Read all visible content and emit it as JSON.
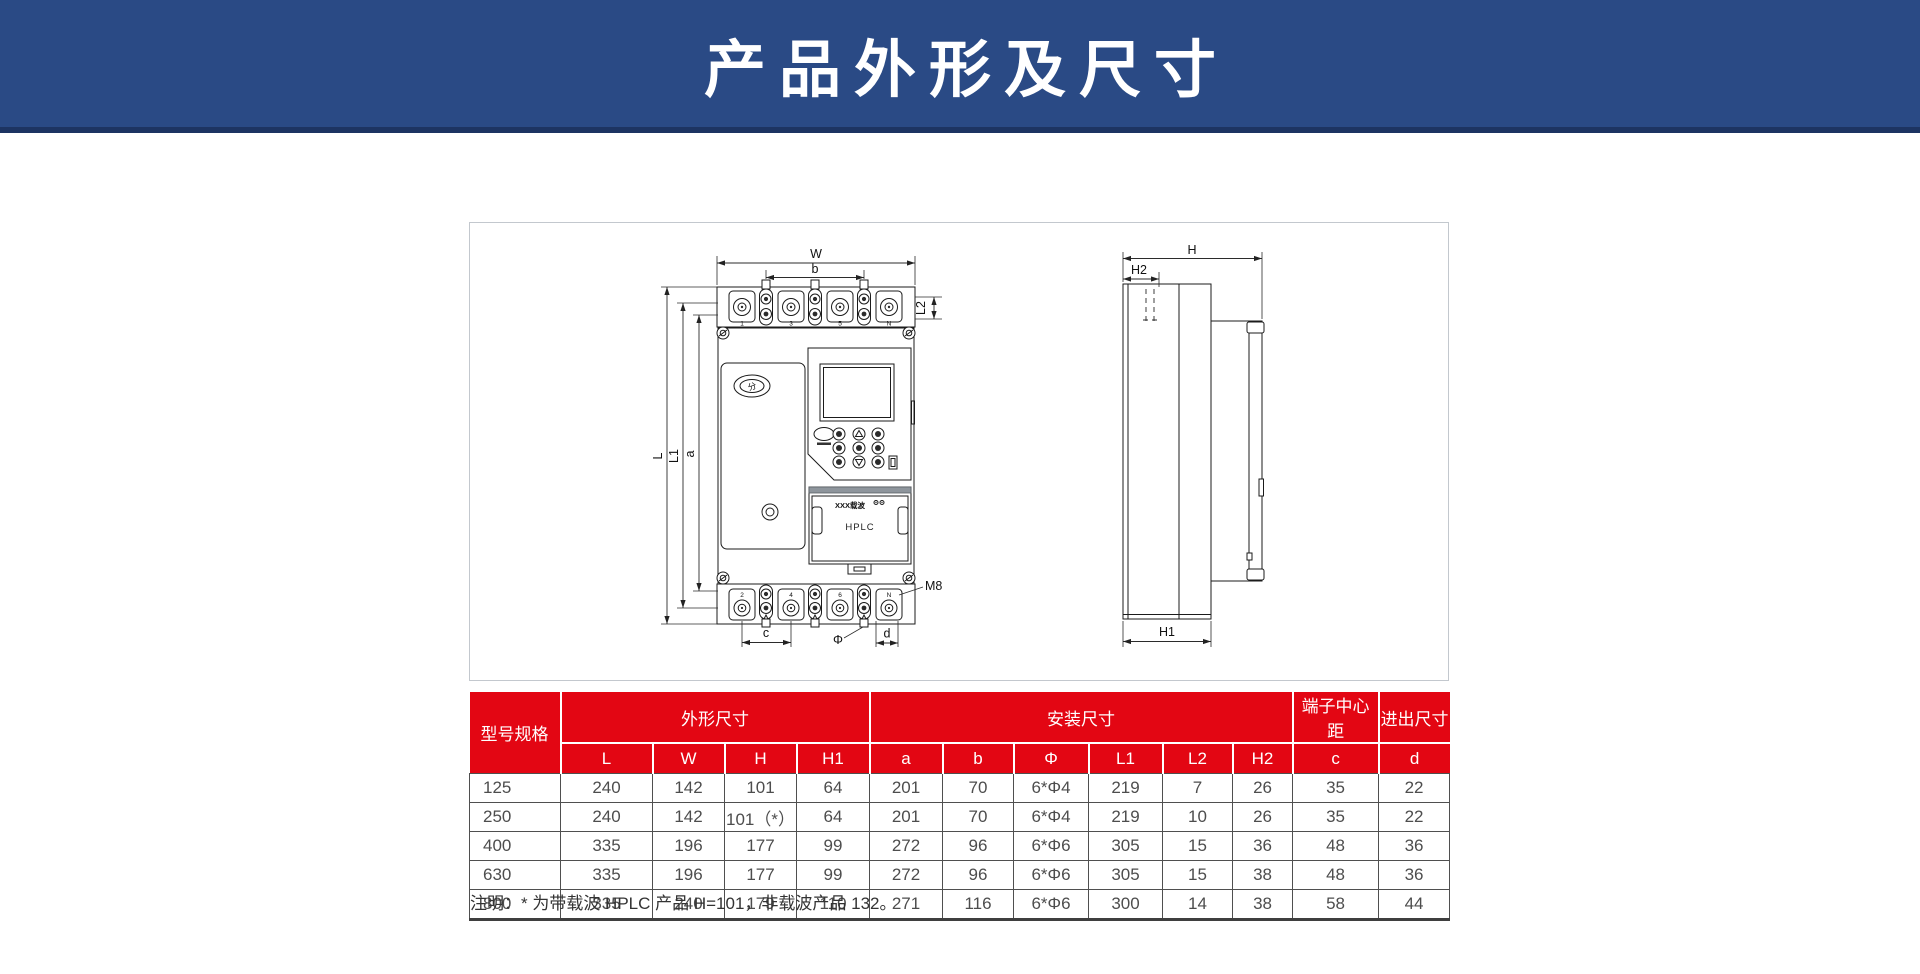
{
  "header": {
    "title": "产品外形及尺寸",
    "bg_color": "#2a4a85",
    "strip_color": "#1d3462"
  },
  "diagram": {
    "dims": {
      "W": "W",
      "b": "b",
      "L2": "L2",
      "L": "L",
      "L1": "L1",
      "a": "a",
      "c": "c",
      "phi": "Φ",
      "d": "d",
      "m8": "M8",
      "H": "H",
      "H2": "H2",
      "H1": "H1"
    },
    "front_view": {
      "top_terminals": [
        "1",
        "3",
        "5",
        "N"
      ],
      "bottom_terminals": [
        "2",
        "4",
        "6",
        "N"
      ],
      "open_button": "分",
      "module_brand": "XXX载波",
      "module_name": "HPLC"
    }
  },
  "table": {
    "colors": {
      "header_bg": "#e30613",
      "header_text": "#ffffff",
      "cell_text": "#4d4d4d"
    },
    "group_headers": {
      "model": "型号规格",
      "outline": "外形尺寸",
      "mounting": "安装尺寸",
      "terminal_pitch": "端子中心距",
      "inout": "进出尺寸"
    },
    "columns": [
      "L",
      "W",
      "H",
      "H1",
      "a",
      "b",
      "Φ",
      "L1",
      "L2",
      "H2",
      "c",
      "d"
    ],
    "rows": [
      {
        "model": "125",
        "values": [
          "240",
          "142",
          "101",
          "64",
          "201",
          "70",
          "6*Φ4",
          "219",
          "7",
          "26",
          "35",
          "22"
        ]
      },
      {
        "model": "250",
        "values": [
          "240",
          "142",
          "101（*）",
          "64",
          "201",
          "70",
          "6*Φ4",
          "219",
          "10",
          "26",
          "35",
          "22"
        ]
      },
      {
        "model": "400",
        "values": [
          "335",
          "196",
          "177",
          "99",
          "272",
          "96",
          "6*Φ6",
          "305",
          "15",
          "36",
          "48",
          "36"
        ]
      },
      {
        "model": "630",
        "values": [
          "335",
          "196",
          "177",
          "99",
          "272",
          "96",
          "6*Φ6",
          "305",
          "15",
          "38",
          "48",
          "36"
        ]
      },
      {
        "model": "800",
        "values": [
          "335",
          "240",
          "179",
          "110",
          "271",
          "116",
          "6*Φ6",
          "300",
          "14",
          "38",
          "58",
          "44"
        ]
      }
    ],
    "note": "注明：* 为带载波 HPLC 产品 H=101，非载波产品 132。"
  }
}
